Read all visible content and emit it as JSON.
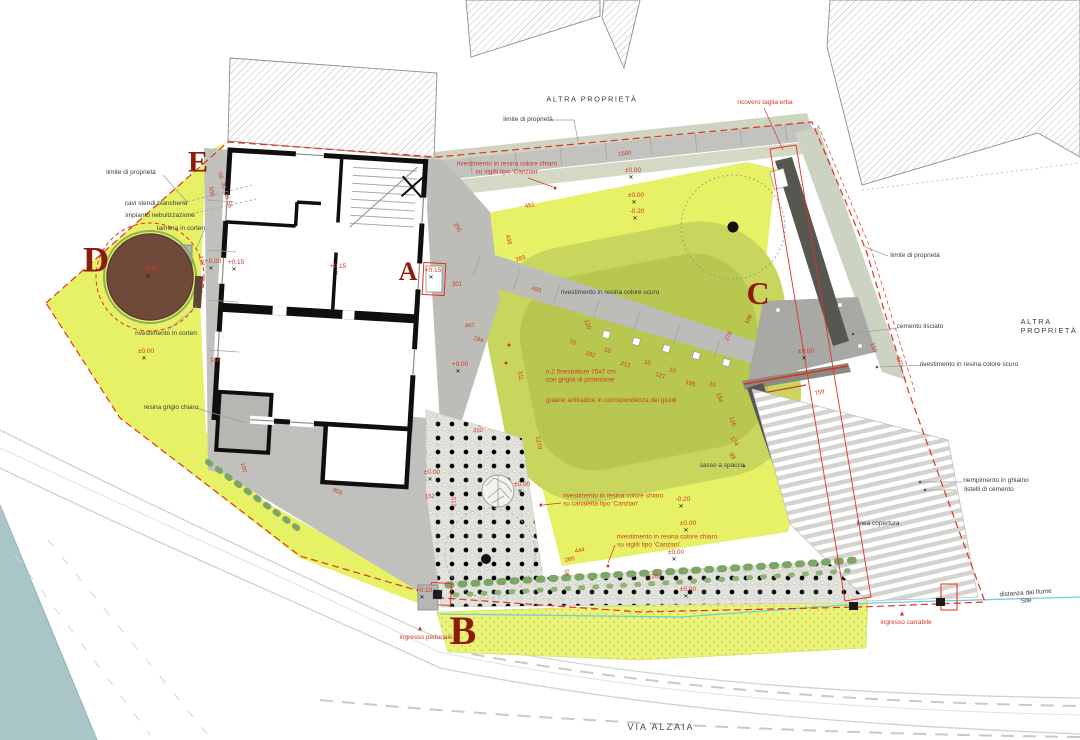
{
  "labels_fixed": {
    "via_alzaia": "VIA ALZAIA",
    "altra_top": "ALTRA PROPRIETÀ",
    "altra_right": "ALTRA PROPRIETÀ"
  },
  "zone_letters": [
    {
      "t": "A",
      "x": 408,
      "y": 272,
      "s": 26
    },
    {
      "t": "B",
      "x": 463,
      "y": 631,
      "s": 40
    },
    {
      "t": "C",
      "x": 758,
      "y": 294,
      "s": 32
    },
    {
      "t": "D",
      "x": 96,
      "y": 260,
      "s": 36
    },
    {
      "t": "E",
      "x": 198,
      "y": 162,
      "s": 30
    }
  ],
  "labels_black": [
    {
      "t": "limite di proprietà",
      "x": 528,
      "y": 120
    },
    {
      "t": "limite di proprietà",
      "x": 131,
      "y": 173
    },
    {
      "t": "cavi stendi biancheria",
      "x": 156,
      "y": 204
    },
    {
      "t": "impianto nebulizzazione",
      "x": 160,
      "y": 216
    },
    {
      "t": "lamiera in corten",
      "x": 181,
      "y": 229
    },
    {
      "t": "rivestimento in corten",
      "x": 166,
      "y": 334
    },
    {
      "t": "resina grigio chiaro",
      "x": 171,
      "y": 408
    },
    {
      "t": "limite di proprietà",
      "x": 915,
      "y": 256
    },
    {
      "t": "cemento lisciato",
      "x": 920,
      "y": 327
    },
    {
      "t": "rivestimento in resina colore scuro",
      "x": 969,
      "y": 365
    },
    {
      "t": "riempimento in ghiaino",
      "x": 996,
      "y": 481
    },
    {
      "t": "listelli di cemento",
      "x": 989,
      "y": 490
    },
    {
      "t": "linea copertura",
      "x": 878,
      "y": 524
    },
    {
      "t": "distanza dal fiume Sile",
      "x": 1026,
      "y": 598,
      "r": -4
    },
    {
      "t": "rivestimento in resina colore scuro",
      "x": 610,
      "y": 293
    },
    {
      "t": "sasso a spacco",
      "x": 722,
      "y": 466
    }
  ],
  "labels_red": [
    {
      "t": "ricovero taglia erba",
      "x": 765,
      "y": 103
    },
    {
      "t": "rivestimento in resina colore chiaro\nsu sigilli tipo 'Canzian'",
      "x": 507,
      "y": 169
    },
    {
      "t": "rivestimento in resina colore chiaro\nsu canaletta tipo 'Canzian'",
      "x": 563,
      "y": 501,
      "a": "l"
    },
    {
      "t": "rivestimento in resina colore chiaro\nsu sigilli tipo 'Canzian'",
      "x": 617,
      "y": 542,
      "a": "l"
    },
    {
      "t": "n.2 finestrature 75x7 cm\ncon griglia di protezione",
      "x": 546,
      "y": 377,
      "a": "l"
    },
    {
      "t": "guaine antiradice in corrispondenza dei giunti",
      "x": 546,
      "y": 401,
      "a": "l"
    },
    {
      "t": "ingresso pedonale",
      "x": 426,
      "y": 638
    },
    {
      "t": "ingresso carrabile",
      "x": 906,
      "y": 623
    }
  ],
  "arrows": [
    {
      "t": "▲",
      "x": 420,
      "y": 629
    },
    {
      "t": "▲",
      "x": 902,
      "y": 614
    }
  ],
  "elevations": [
    {
      "t": "±0.00",
      "x": 633,
      "y": 171
    },
    {
      "t": "±0.00",
      "x": 636,
      "y": 196
    },
    {
      "t": "-0.20",
      "x": 637,
      "y": 212
    },
    {
      "t": "+0.00",
      "x": 213,
      "y": 262
    },
    {
      "t": "+0.15",
      "x": 236,
      "y": 263
    },
    {
      "t": "+0.15",
      "x": 338,
      "y": 267
    },
    {
      "t": "+0.15",
      "x": 433,
      "y": 271
    },
    {
      "t": "+0.00",
      "x": 460,
      "y": 365
    },
    {
      "t": "±0.00",
      "x": 146,
      "y": 352
    },
    {
      "t": "±0.00",
      "x": 806,
      "y": 352
    },
    {
      "t": "-0.20",
      "x": 683,
      "y": 500
    },
    {
      "t": "±0.00",
      "x": 688,
      "y": 524
    },
    {
      "t": "±0.00",
      "x": 676,
      "y": 553
    },
    {
      "t": "±0.00",
      "x": 688,
      "y": 590
    },
    {
      "t": "±0.00",
      "x": 432,
      "y": 473
    },
    {
      "t": "±0.00",
      "x": 522,
      "y": 485
    },
    {
      "t": "+0.10",
      "x": 424,
      "y": 591
    },
    {
      "t": "+0.45",
      "x": 150,
      "y": 270
    }
  ],
  "dimensions": [
    {
      "t": "1600",
      "x": 625,
      "y": 155,
      "r": -8
    },
    {
      "t": "451",
      "x": 530,
      "y": 207,
      "r": -10
    },
    {
      "t": "438",
      "x": 507,
      "y": 240,
      "r": 75
    },
    {
      "t": "283",
      "x": 521,
      "y": 260,
      "r": -18
    },
    {
      "t": "493",
      "x": 536,
      "y": 291,
      "r": 14
    },
    {
      "t": "250",
      "x": 456,
      "y": 228,
      "r": 60
    },
    {
      "t": "301",
      "x": 457,
      "y": 286,
      "r": 0
    },
    {
      "t": "467",
      "x": 470,
      "y": 327,
      "r": -3
    },
    {
      "t": "294",
      "x": 478,
      "y": 341,
      "r": 17
    },
    {
      "t": "70",
      "x": 572,
      "y": 344,
      "r": 17
    },
    {
      "t": "162",
      "x": 590,
      "y": 356,
      "r": 17
    },
    {
      "t": "10",
      "x": 607,
      "y": 352,
      "r": 17
    },
    {
      "t": "212",
      "x": 625,
      "y": 366,
      "r": 17
    },
    {
      "t": "10",
      "x": 647,
      "y": 364,
      "r": 17
    },
    {
      "t": "121",
      "x": 660,
      "y": 377,
      "r": 17
    },
    {
      "t": "10",
      "x": 672,
      "y": 372,
      "r": 17
    },
    {
      "t": "195",
      "x": 690,
      "y": 385,
      "r": 17
    },
    {
      "t": "10",
      "x": 712,
      "y": 386,
      "r": 17
    },
    {
      "t": "154",
      "x": 718,
      "y": 398,
      "r": 72
    },
    {
      "t": "125",
      "x": 731,
      "y": 422,
      "r": 72
    },
    {
      "t": "174",
      "x": 733,
      "y": 442,
      "r": 58
    },
    {
      "t": "99",
      "x": 731,
      "y": 457,
      "r": 58
    },
    {
      "t": "120",
      "x": 586,
      "y": 325,
      "r": 70
    },
    {
      "t": "311",
      "x": 519,
      "y": 376,
      "r": 80
    },
    {
      "t": "556",
      "x": 210,
      "y": 192,
      "r": 78
    },
    {
      "t": "128",
      "x": 200,
      "y": 261,
      "r": 78
    },
    {
      "t": "56",
      "x": 219,
      "y": 176,
      "r": 75
    },
    {
      "t": "30",
      "x": 222,
      "y": 186,
      "r": 75
    },
    {
      "t": "30",
      "x": 225,
      "y": 196,
      "r": 75
    },
    {
      "t": "56",
      "x": 228,
      "y": 205,
      "r": 75
    },
    {
      "t": "148",
      "x": 215,
      "y": 362,
      "r": 0
    },
    {
      "t": "100",
      "x": 242,
      "y": 468,
      "r": 75
    },
    {
      "t": "855",
      "x": 337,
      "y": 493,
      "r": 24
    },
    {
      "t": "310",
      "x": 478,
      "y": 432,
      "r": -3
    },
    {
      "t": "1270",
      "x": 537,
      "y": 443,
      "r": 80
    },
    {
      "t": "152",
      "x": 430,
      "y": 498,
      "r": -4
    },
    {
      "t": "513",
      "x": 452,
      "y": 502,
      "r": 85
    },
    {
      "t": "444",
      "x": 580,
      "y": 552,
      "r": -10
    },
    {
      "t": "260",
      "x": 570,
      "y": 561,
      "r": -10
    },
    {
      "t": "56",
      "x": 565,
      "y": 573,
      "r": 80
    },
    {
      "t": "1282",
      "x": 655,
      "y": 578,
      "r": -4
    },
    {
      "t": "278",
      "x": 730,
      "y": 337,
      "r": -62
    },
    {
      "t": "186",
      "x": 750,
      "y": 320,
      "r": -62
    },
    {
      "t": "759",
      "x": 820,
      "y": 394,
      "r": -14
    },
    {
      "t": "150",
      "x": 872,
      "y": 348,
      "r": 70
    },
    {
      "t": "120",
      "x": 898,
      "y": 362,
      "r": 70
    }
  ],
  "colors": {
    "boundary_red": "#e23222",
    "annotation_red": "#cf3a23",
    "zone_letter_red": "#8f1a0c",
    "lawn_yellow": "#e6f166",
    "pond_olive": "#c9d65e",
    "pond_olive_dark": "#b7c74f",
    "path_gray": "#c0c1bd",
    "plaza_gray": "#a8a8a4",
    "wall_dark": "#57564f",
    "corten_brown": "#6f4a3a",
    "river_teal": "#aac5c8",
    "dimension_line_cyan": "#6fced9"
  },
  "icons": [
    "benchmark-icon",
    "entrance-arrow-icon"
  ]
}
